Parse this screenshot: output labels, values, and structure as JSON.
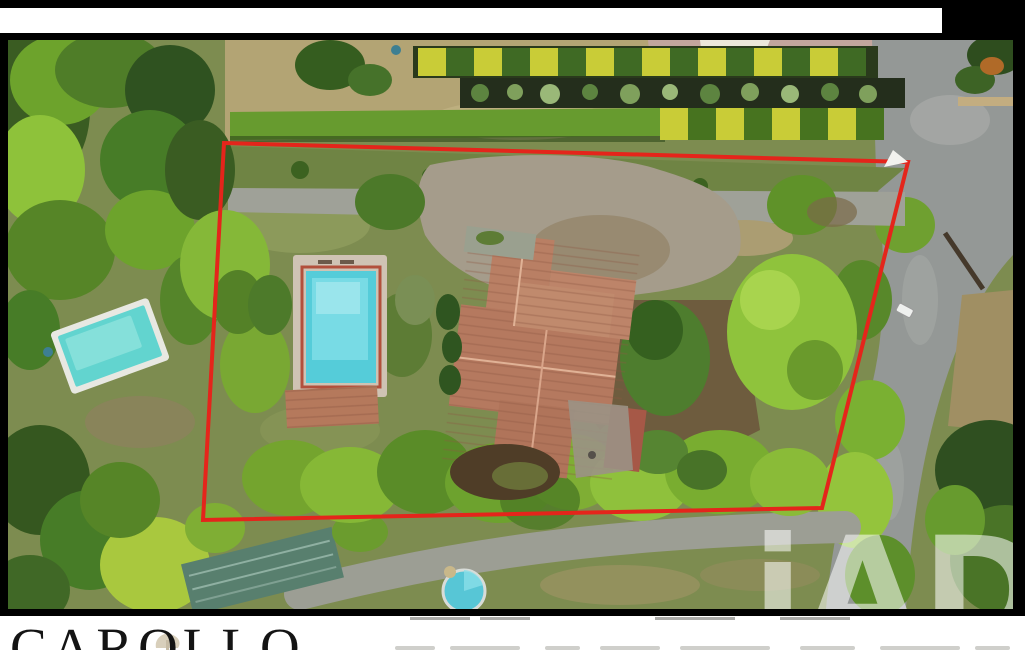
{
  "branding": {
    "agency_name": "CAROLLO",
    "watermark": "iAD"
  },
  "photo_labels": {
    "type": "aerial-drone-photo-of-property",
    "boundary": "red-plot-outline"
  },
  "colors": {
    "frame_black": "#000000",
    "band_white": "#ffffff",
    "boundary_red": "#e4251b",
    "pool_water": "#55ccd9",
    "neighbor_pool_water": "#62d4cf",
    "roof_terracotta": "#b5795f",
    "road_gray": "#949896",
    "grass_olive": "#7d8c50",
    "lawn_tan": "#b3a474",
    "hedge_green": "#679b2f",
    "hedge_yellow": "#c9cc37",
    "shed_green": "#587f6e",
    "watermark_white": "#ffffff"
  }
}
